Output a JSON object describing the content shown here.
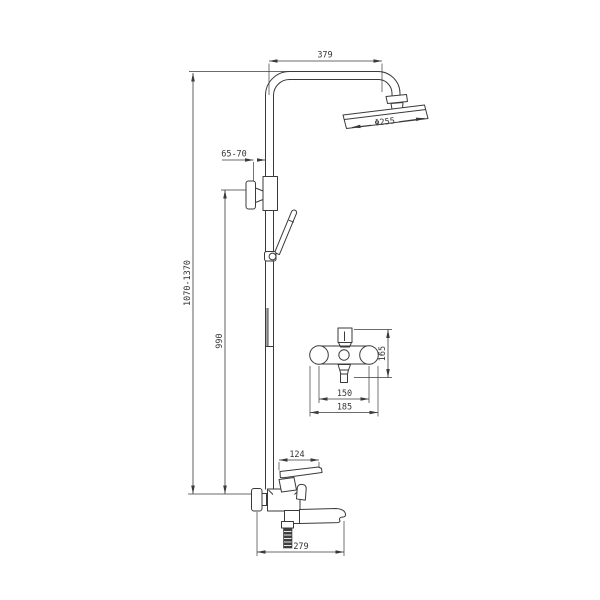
{
  "drawing": {
    "kind": "shower-column-technical-drawing",
    "background_color": "#ffffff",
    "line_color": "#3a3a3a",
    "dimensions": {
      "arm_reach": "379",
      "head_diameter": "Φ255",
      "wall_offset": "65-70",
      "overall_height": "1070-1370",
      "riser_height": "990",
      "mixer_height": "165",
      "mixer_hole_spacing": "150",
      "mixer_width": "185",
      "handle_length": "124",
      "spout_reach": "279"
    }
  }
}
